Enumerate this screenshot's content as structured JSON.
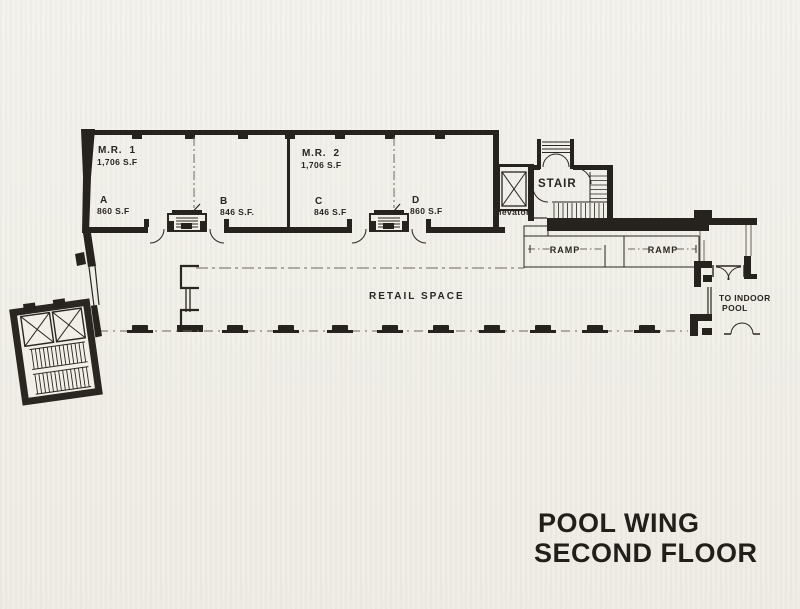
{
  "page": {
    "title_line1": "POOL WING",
    "title_line2": "SECOND FLOOR"
  },
  "colors": {
    "paper": "#f1efe8",
    "ink": "#26221d",
    "faint_line": "#6e675c"
  },
  "rooms": [
    {
      "name": "M.R.  1",
      "area": "1,706 S.F"
    },
    {
      "name": "A",
      "area": "860 S.F"
    },
    {
      "name": "B",
      "area": "846 S.F."
    },
    {
      "name": "M.R.  2",
      "area": "1,706 S.F"
    },
    {
      "name": "C",
      "area": "846 S.F"
    },
    {
      "name": "D",
      "area": "860 S.F"
    }
  ],
  "labels": {
    "elevator": "Elevator",
    "stair": "STAIR",
    "ramp_left": "RAMP",
    "ramp_right": "RAMP",
    "retail_space": "RETAIL SPACE",
    "to_indoor_pool_line1": "TO INDOOR",
    "to_indoor_pool_line2": "POOL"
  }
}
